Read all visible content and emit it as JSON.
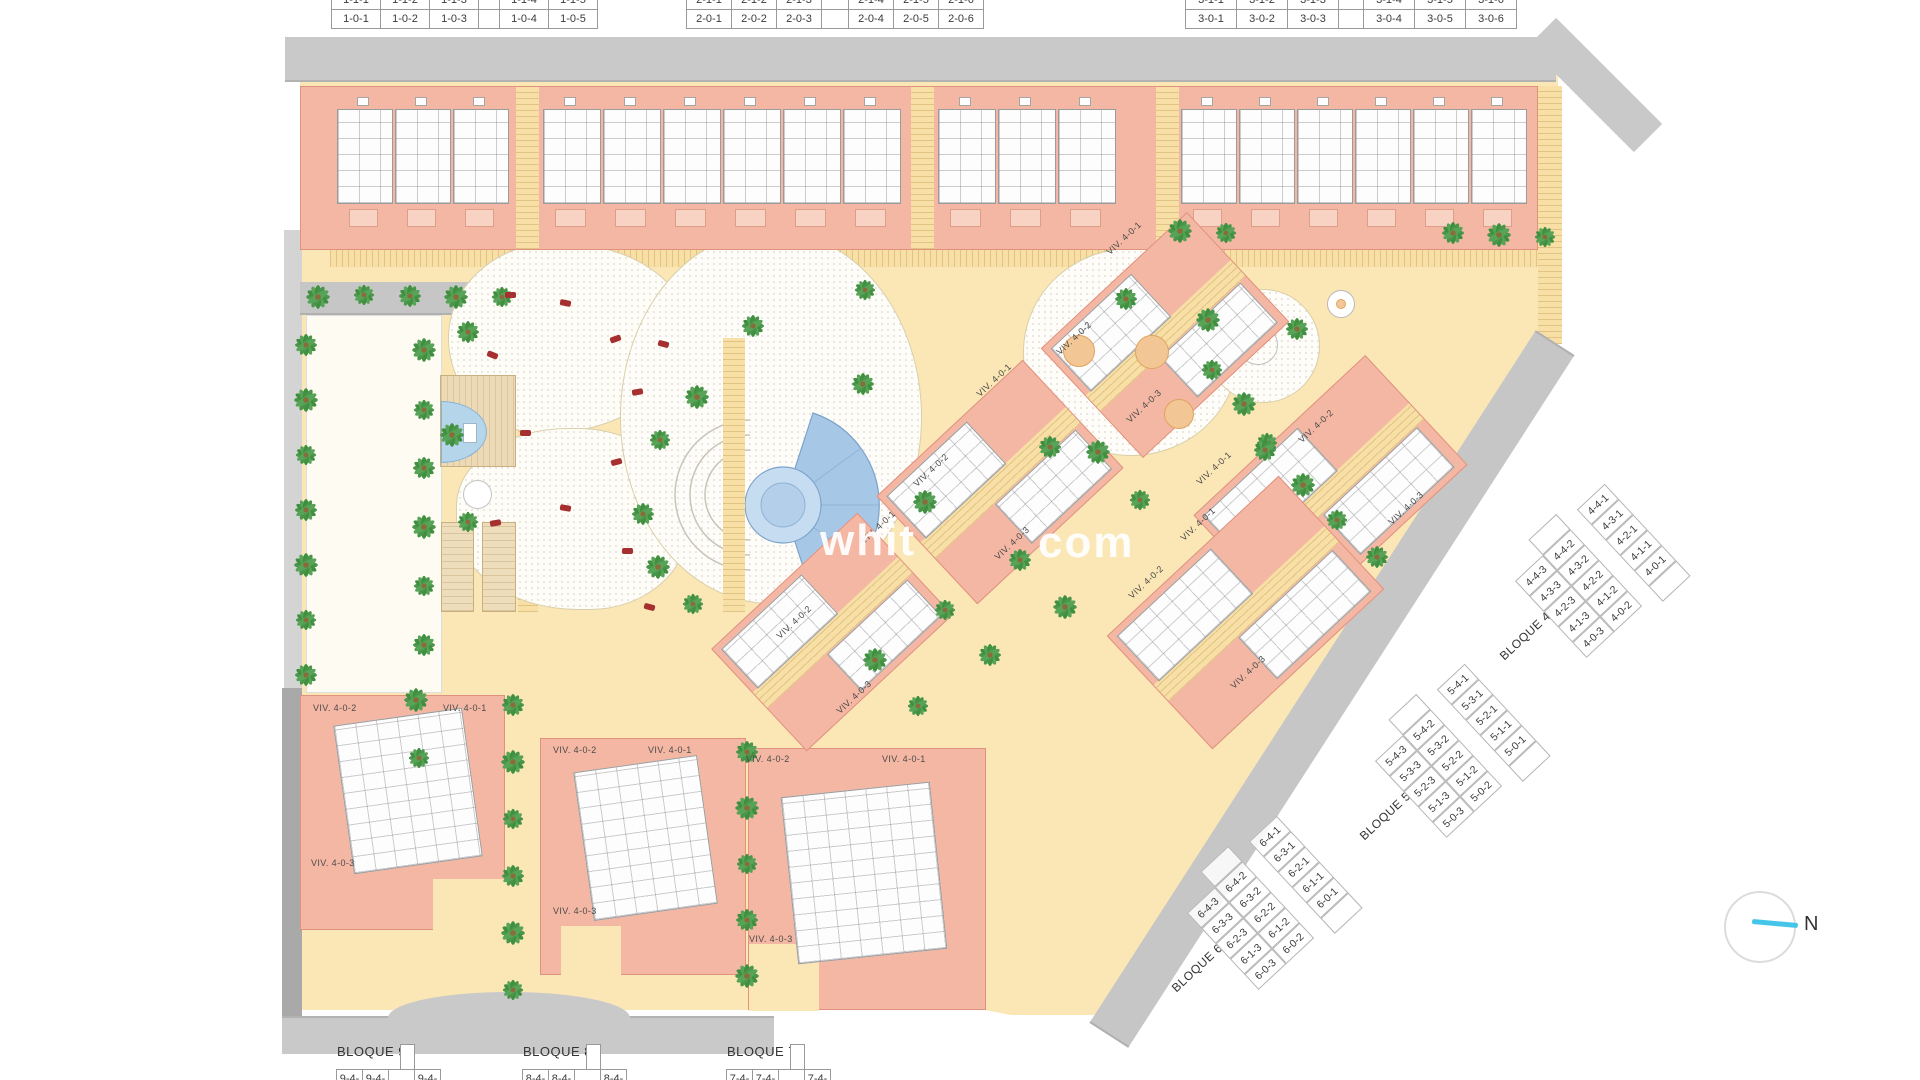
{
  "colors": {
    "building_pink": "#f4b7a4",
    "building_outline": "#e0927e",
    "sand": "#fbe7b5",
    "sand_hatch": "#e3c07c",
    "road_gray": "#c9c9c9",
    "road_dark": "#aeaeae",
    "plan_white": "#fdfdfd",
    "pool_blue": "#a7c7e6",
    "pool_ring": "#7aa3cb",
    "palm_green": "#3f8f3f",
    "orange_circle": "#f3c795",
    "lounger_red": "#a62f2f",
    "lawn": "#fdfbf2",
    "deck_tan": "#ecd9b6",
    "compass_cyan": "#45c6e8"
  },
  "top_tables": [
    {
      "id": "bloque-1-table",
      "x": 332,
      "cell_w": 50,
      "gap_w": 22,
      "rows": [
        [
          "1-1-1",
          "1-1-2",
          "1-1-3",
          "|",
          "1-1-4",
          "1-1-5"
        ],
        [
          "1-0-1",
          "1-0-2",
          "1-0-3",
          "|",
          "1-0-4",
          "1-0-5"
        ]
      ]
    },
    {
      "id": "bloque-2-table",
      "x": 687,
      "cell_w": 46,
      "gap_w": 28,
      "rows": [
        [
          "2-1-1",
          "2-1-2",
          "2-1-3",
          "|",
          "2-1-4",
          "2-1-5",
          "2-1-6"
        ],
        [
          "2-0-1",
          "2-0-2",
          "2-0-3",
          "|",
          "2-0-4",
          "2-0-5",
          "2-0-6"
        ]
      ]
    },
    {
      "id": "bloque-3-table",
      "x": 1186,
      "cell_w": 52,
      "gap_w": 26,
      "rows": [
        [
          "3-1-1",
          "3-1-2",
          "3-1-3",
          "|",
          "3-1-4",
          "3-1-5",
          "3-1-6"
        ],
        [
          "3-0-1",
          "3-0-2",
          "3-0-3",
          "|",
          "3-0-4",
          "3-0-5",
          "3-0-6"
        ]
      ]
    }
  ],
  "bottom_tables": [
    {
      "label": "BLOQUE 9",
      "x": 337,
      "cells": [
        "9-4-3",
        "9-4-2",
        "|",
        "9-4-1"
      ]
    },
    {
      "label": "BLOQUE 8",
      "x": 523,
      "cells": [
        "8-4-3",
        "8-4-2",
        "|",
        "8-4-1"
      ]
    },
    {
      "label": "BLOQUE 7",
      "x": 727,
      "cells": [
        "7-4-3",
        "7-4-2",
        "|",
        "7-4-1"
      ]
    }
  ],
  "diagonal_tables": [
    {
      "label": "BLOQUE 4",
      "cx": 1590,
      "cy": 600,
      "angle": -43,
      "rows": [
        [
          "4-4-3",
          "4-4-2",
          "4-4-1"
        ],
        [
          "4-3-3",
          "4-3-2",
          "4-3-1"
        ],
        [
          "4-2-3",
          "4-2-2",
          "4-2-1"
        ],
        [
          "4-1-3",
          "4-1-2",
          "4-1-1"
        ],
        [
          "4-0-3",
          "4-0-2",
          "4-0-1"
        ]
      ]
    },
    {
      "label": "BLOQUE 5",
      "cx": 1450,
      "cy": 780,
      "angle": -43,
      "rows": [
        [
          "5-4-3",
          "5-4-2",
          "5-4-1"
        ],
        [
          "5-3-3",
          "5-3-2",
          "5-3-1"
        ],
        [
          "5-2-3",
          "5-2-2",
          "5-2-1"
        ],
        [
          "5-1-3",
          "5-1-2",
          "5-1-1"
        ],
        [
          "5-0-3",
          "5-0-2",
          "5-0-1"
        ]
      ]
    },
    {
      "label": "BLOQUE 6",
      "cx": 1262,
      "cy": 932,
      "angle": -43,
      "rows": [
        [
          "6-4-3",
          "6-4-2",
          "6-4-1"
        ],
        [
          "6-3-3",
          "6-3-2",
          "6-3-1"
        ],
        [
          "6-2-3",
          "6-2-2",
          "6-2-1"
        ],
        [
          "6-1-3",
          "6-1-2",
          "6-1-1"
        ],
        [
          "6-0-3",
          "6-0-2",
          "6-0-1"
        ]
      ]
    }
  ],
  "viv_labels": [
    {
      "text": "VIV. 4-0-1",
      "x": 1108,
      "y": 248,
      "r": -43
    },
    {
      "text": "VIV. 4-0-2",
      "x": 1058,
      "y": 348,
      "r": -43
    },
    {
      "text": "VIV. 4-0-3",
      "x": 1128,
      "y": 416,
      "r": -43
    },
    {
      "text": "VIV. 4-0-1",
      "x": 978,
      "y": 390,
      "r": -43
    },
    {
      "text": "VIV. 4-0-2",
      "x": 915,
      "y": 480,
      "r": -43
    },
    {
      "text": "VIV. 4-0-3",
      "x": 996,
      "y": 553,
      "r": -43
    },
    {
      "text": "VIV. 4-0-1",
      "x": 1198,
      "y": 478,
      "r": -43
    },
    {
      "text": "VIV. 4-0-2",
      "x": 1300,
      "y": 436,
      "r": -43
    },
    {
      "text": "VIV. 4-0-3",
      "x": 1390,
      "y": 518,
      "r": -43
    },
    {
      "text": "VIV. 4-0-1",
      "x": 1182,
      "y": 534,
      "r": -43
    },
    {
      "text": "VIV. 4-0-2",
      "x": 1130,
      "y": 592,
      "r": -43
    },
    {
      "text": "VIV. 4-0-3",
      "x": 1232,
      "y": 682,
      "r": -43
    },
    {
      "text": "VIV. 4-0-1",
      "x": 862,
      "y": 537,
      "r": -43
    },
    {
      "text": "VIV. 4-0-2",
      "x": 778,
      "y": 632,
      "r": -43
    },
    {
      "text": "VIV. 4-0-3",
      "x": 838,
      "y": 707,
      "r": -43
    },
    {
      "text": "VIV. 4-0-2",
      "x": 313,
      "y": 703,
      "r": 0
    },
    {
      "text": "VIV. 4-0-1",
      "x": 443,
      "y": 703,
      "r": 0
    },
    {
      "text": "VIV. 4-0-3",
      "x": 311,
      "y": 858,
      "r": 0
    },
    {
      "text": "VIV. 4-0-2",
      "x": 553,
      "y": 745,
      "r": 0
    },
    {
      "text": "VIV. 4-0-1",
      "x": 648,
      "y": 745,
      "r": 0
    },
    {
      "text": "VIV. 4-0-3",
      "x": 553,
      "y": 906,
      "r": 0
    },
    {
      "text": "VIV. 4-0-2",
      "x": 746,
      "y": 754,
      "r": 0
    },
    {
      "text": "VIV. 4-0-1",
      "x": 882,
      "y": 754,
      "r": 0
    },
    {
      "text": "VIV. 4-0-3",
      "x": 749,
      "y": 934,
      "r": 0
    }
  ],
  "top_band": {
    "x": 300,
    "y": 86,
    "w": 1238,
    "h": 164,
    "paths": [
      515,
      910,
      1155
    ],
    "unit_groups": [
      {
        "x": 336,
        "n": 3,
        "w": 58
      },
      {
        "x": 542,
        "n": 6,
        "w": 60
      },
      {
        "x": 937,
        "n": 3,
        "w": 60
      },
      {
        "x": 1180,
        "n": 6,
        "w": 58
      }
    ]
  },
  "bottom_blocks": [
    {
      "x": 300,
      "y": 695,
      "w": 205,
      "h": 235,
      "notch": [
        132,
        183,
        73,
        52
      ],
      "cluster": [
        42,
        20,
        130,
        150,
        -8
      ]
    },
    {
      "x": 540,
      "y": 738,
      "w": 206,
      "h": 237,
      "notch": [
        20,
        187,
        60,
        50
      ],
      "cluster": [
        42,
        24,
        125,
        150,
        -8
      ]
    },
    {
      "x": 748,
      "y": 748,
      "w": 238,
      "h": 262,
      "notch": [
        0,
        195,
        70,
        67
      ],
      "cluster": [
        40,
        40,
        150,
        168,
        -6
      ]
    }
  ],
  "diag_clusters": [
    {
      "cx": 1165,
      "cy": 335,
      "w": 200,
      "h": 150,
      "r": -43
    },
    {
      "cx": 1330,
      "cy": 490,
      "w": 235,
      "h": 150,
      "r": -43
    },
    {
      "cx": 1245,
      "cy": 612,
      "w": 235,
      "h": 155,
      "r": -43
    },
    {
      "cx": 1000,
      "cy": 482,
      "w": 200,
      "h": 148,
      "r": -43
    },
    {
      "cx": 832,
      "cy": 632,
      "w": 200,
      "h": 140,
      "r": -43
    }
  ],
  "play_circles": [
    [
      1078,
      350,
      15
    ],
    [
      1151,
      351,
      16
    ],
    [
      1178,
      413,
      14
    ]
  ],
  "palms": [
    [
      318,
      297
    ],
    [
      364,
      295
    ],
    [
      410,
      296
    ],
    [
      456,
      297
    ],
    [
      502,
      297
    ],
    [
      306,
      345
    ],
    [
      306,
      400
    ],
    [
      306,
      455
    ],
    [
      306,
      510
    ],
    [
      306,
      565
    ],
    [
      306,
      620
    ],
    [
      306,
      675
    ],
    [
      424,
      350
    ],
    [
      424,
      410
    ],
    [
      424,
      468
    ],
    [
      424,
      527
    ],
    [
      424,
      586
    ],
    [
      424,
      645
    ],
    [
      416,
      700
    ],
    [
      419,
      758
    ],
    [
      468,
      332
    ],
    [
      452,
      435
    ],
    [
      468,
      522
    ],
    [
      753,
      326
    ],
    [
      697,
      397
    ],
    [
      660,
      440
    ],
    [
      643,
      514
    ],
    [
      658,
      567
    ],
    [
      693,
      604
    ],
    [
      863,
      384
    ],
    [
      925,
      502
    ],
    [
      865,
      290
    ],
    [
      1126,
      299
    ],
    [
      1208,
      320
    ],
    [
      1212,
      370
    ],
    [
      1297,
      329
    ],
    [
      1244,
      404
    ],
    [
      1267,
      443
    ],
    [
      1050,
      447
    ],
    [
      1180,
      231
    ],
    [
      1226,
      233
    ],
    [
      1453,
      233
    ],
    [
      1499,
      235
    ],
    [
      1545,
      237
    ],
    [
      1265,
      450
    ],
    [
      1303,
      485
    ],
    [
      1337,
      520
    ],
    [
      1377,
      557
    ],
    [
      1098,
      452
    ],
    [
      1140,
      500
    ],
    [
      1020,
      560
    ],
    [
      1065,
      607
    ],
    [
      945,
      610
    ],
    [
      990,
      655
    ],
    [
      875,
      660
    ],
    [
      918,
      706
    ],
    [
      513,
      705
    ],
    [
      513,
      762
    ],
    [
      513,
      819
    ],
    [
      513,
      876
    ],
    [
      513,
      933
    ],
    [
      513,
      990
    ],
    [
      747,
      752
    ],
    [
      747,
      808
    ],
    [
      747,
      864
    ],
    [
      747,
      920
    ],
    [
      747,
      976
    ]
  ],
  "loungers": [
    [
      505,
      292,
      0
    ],
    [
      560,
      300,
      12
    ],
    [
      610,
      336,
      -20
    ],
    [
      658,
      341,
      15
    ],
    [
      487,
      352,
      22
    ],
    [
      632,
      389,
      -10
    ],
    [
      520,
      430,
      0
    ],
    [
      611,
      459,
      -15
    ],
    [
      560,
      505,
      10
    ],
    [
      490,
      520,
      -10
    ],
    [
      622,
      548,
      0
    ],
    [
      644,
      604,
      15
    ]
  ],
  "watermark": {
    "part1": "whit",
    "part2": "com"
  },
  "compass": {
    "label": "N"
  }
}
